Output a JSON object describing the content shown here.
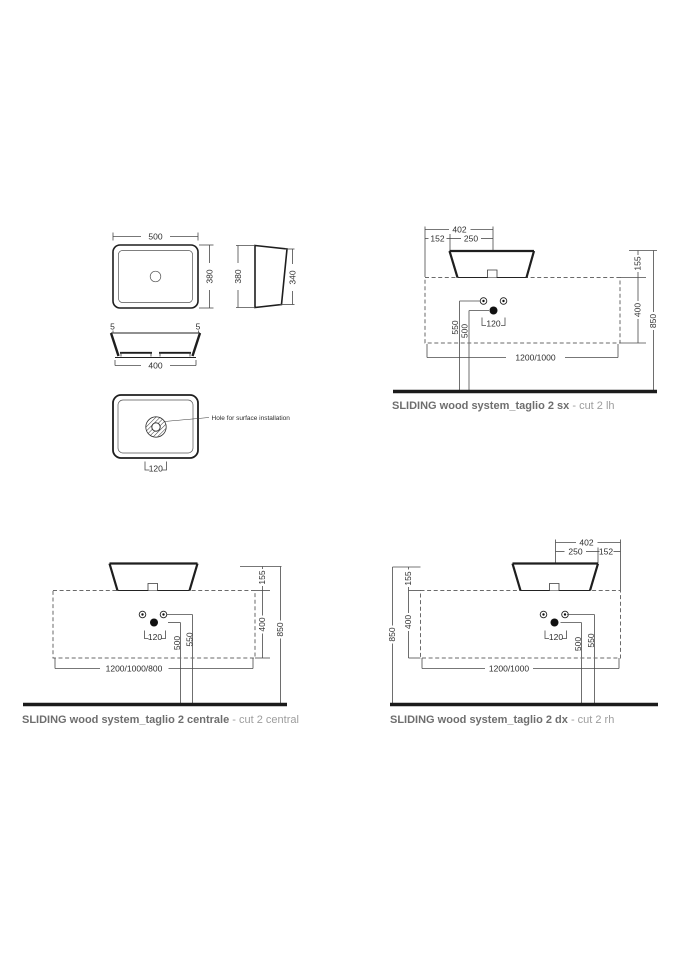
{
  "page": {
    "background": "#ffffff",
    "line_color": "#2e2e2e",
    "caption_color": "#6e6e6e",
    "caption_sub_color": "#9d9d9d"
  },
  "product_views": {
    "top_view": {
      "width": "500",
      "depth": "380"
    },
    "side_view": {
      "front_height": "380",
      "back_height": "340"
    },
    "front_view": {
      "rim_left": "5",
      "rim_right": "5",
      "bottom_width": "400"
    },
    "bottom_view": {
      "note": "Hole for surface installation",
      "hole_size": "120"
    }
  },
  "layouts": {
    "sx": {
      "caption": "SLIDING wood system_taglio 2 sx",
      "caption_sub": "- cut 2 lh",
      "top_total": "402",
      "top_left": "152",
      "top_right": "250",
      "basin_height": "155",
      "counter_height": "400",
      "total_height": "850",
      "supply_height": "550",
      "drain_height": "500",
      "hole_size": "120",
      "counter_widths": "1200/1000"
    },
    "centrale": {
      "caption": "SLIDING wood system_taglio 2 centrale",
      "caption_sub": "- cut 2 central",
      "basin_height": "155",
      "counter_height": "400",
      "total_height": "850",
      "supply_height": "550",
      "drain_height": "500",
      "hole_size": "120",
      "counter_widths": "1200/1000/800"
    },
    "dx": {
      "caption": "SLIDING wood system_taglio 2 dx",
      "caption_sub": "- cut 2 rh",
      "top_total": "402",
      "top_left": "250",
      "top_right": "152",
      "basin_height": "155",
      "counter_height": "400",
      "total_height": "850",
      "supply_height": "550",
      "drain_height": "500",
      "hole_size": "120",
      "counter_widths": "1200/1000"
    }
  }
}
